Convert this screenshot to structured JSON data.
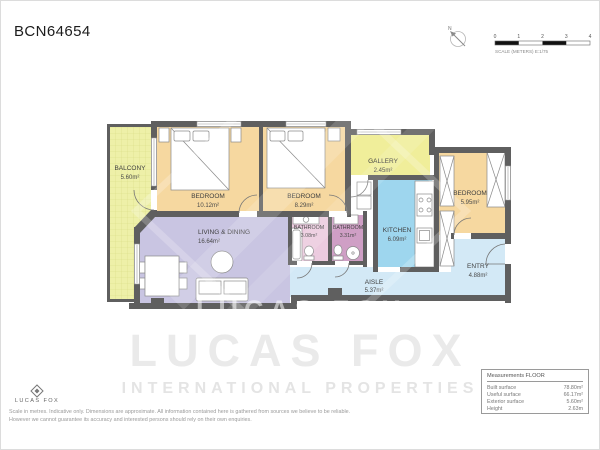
{
  "page": {
    "title": "BCN64654"
  },
  "compass": {
    "north_label": "N"
  },
  "scale_bar": {
    "ticks": [
      "0",
      "1",
      "2",
      "3",
      "4"
    ],
    "label": "SCALE (METERS) E:1/75"
  },
  "plan": {
    "rooms": [
      {
        "name": "BALCONY",
        "area": "5.60m²"
      },
      {
        "name": "BEDROOM",
        "area": "10.12m²"
      },
      {
        "name": "BEDROOM",
        "area": "8.29m²"
      },
      {
        "name": "GALLERY",
        "area": "2.45m²"
      },
      {
        "name": "BEDROOM",
        "area": "5.95m²"
      },
      {
        "name": "LIVING & DINING",
        "area": "16.64m²"
      },
      {
        "name": "BATHROOM",
        "area": "3.08m²"
      },
      {
        "name": "BATHROOM",
        "area": "3.31m²"
      },
      {
        "name": "KITCHEN",
        "area": "6.09m²"
      },
      {
        "name": "AISLE",
        "area": "5.37m²"
      },
      {
        "name": "ENTRY",
        "area": "4.88m²"
      }
    ]
  },
  "watermark": {
    "plan_text": "LUCAS FOX",
    "brand": "LUCAS FOX",
    "tagline": "INTERNATIONAL PROPERTIES"
  },
  "footer": {
    "logo_text": "LUCAS FOX",
    "disclaimer_line1": "Scale in metres. Indicative only. Dimensions are approximate. All information contained here is gathered from sources we believe to be reliable.",
    "disclaimer_line2": "However we cannot guarantee its accuracy and interested persons should rely on their own enquiries."
  },
  "measurements": {
    "title": "Measurements FLOOR",
    "rows": [
      {
        "label": "Built surface",
        "value": "78.80m²"
      },
      {
        "label": "Useful surface",
        "value": "66.17m²"
      },
      {
        "label": "Exterior surface",
        "value": "5.60m²"
      },
      {
        "label": "Height",
        "value": "2.63m"
      }
    ]
  },
  "colors": {
    "wall": "#5f5f5f",
    "bedroom": "#f6d8a0",
    "balcony_base": "#eef0a8",
    "gallery": "#f0ee9a",
    "kitchen": "#9ed6ee",
    "living": "#c9c5e2",
    "bathroom_light": "#eccbdf",
    "bathroom_dark": "#cf9fc5",
    "hall": "#d3e9f6"
  }
}
